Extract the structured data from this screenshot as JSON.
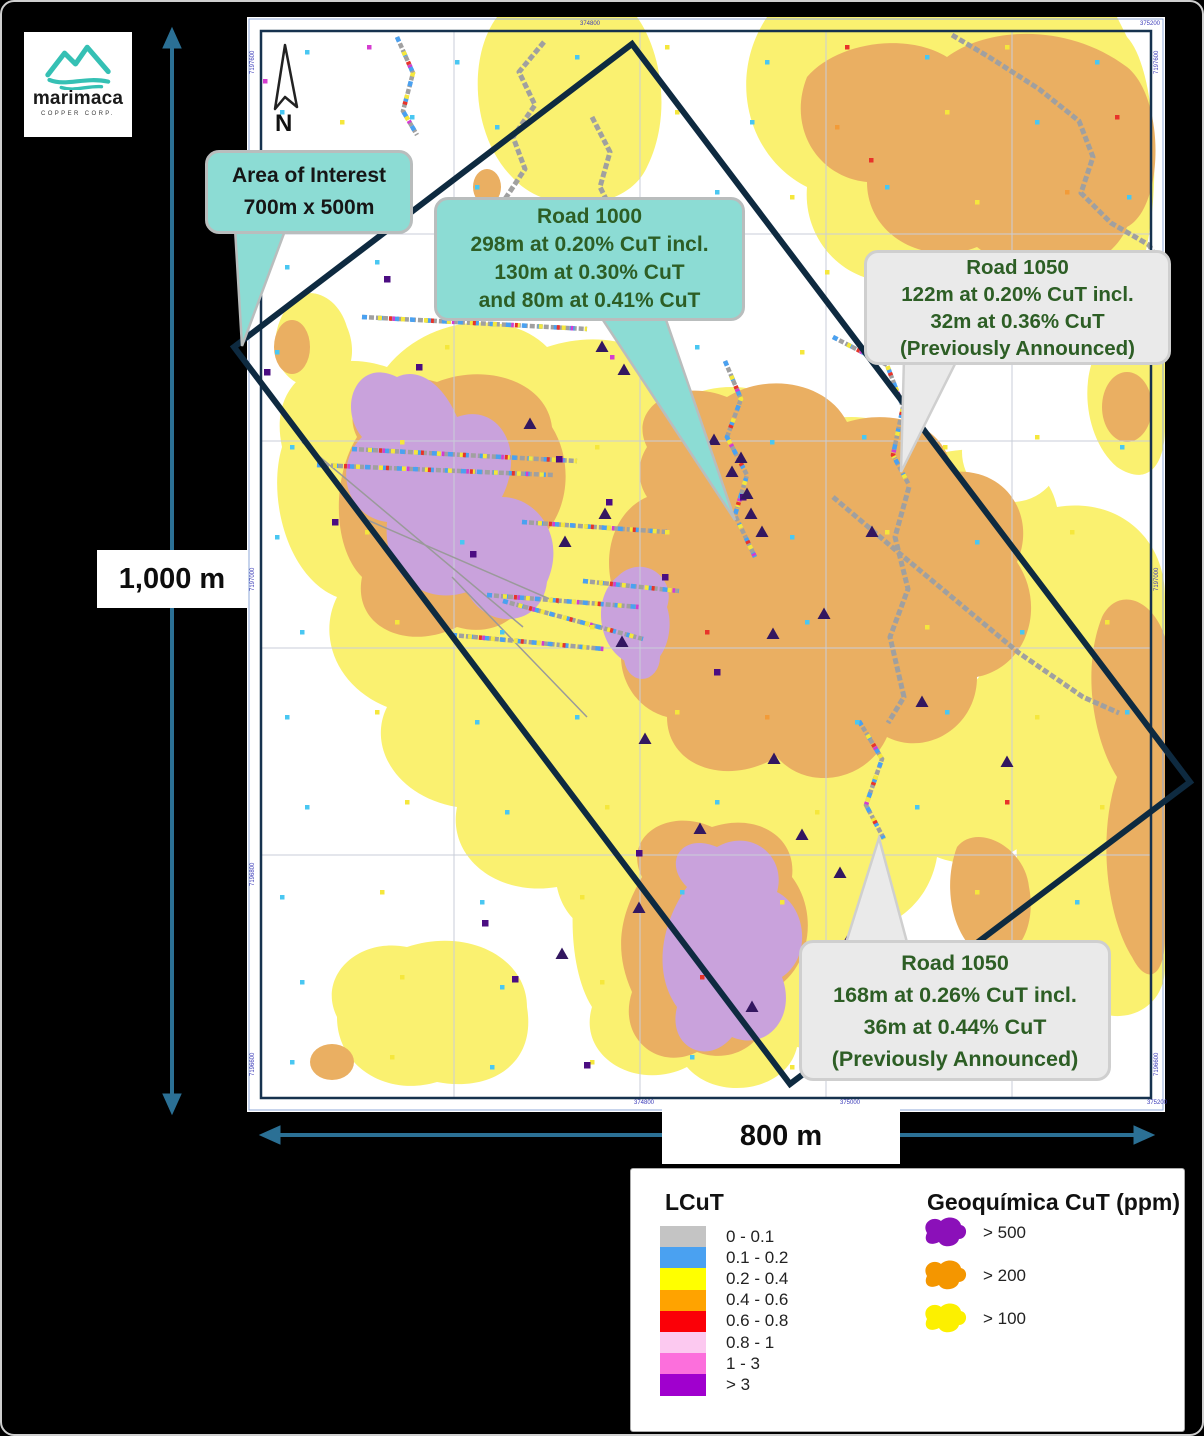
{
  "logo": {
    "wordmark": "marimaca",
    "subtitle": "COPPER CORP.",
    "accent": "#35c0b4"
  },
  "north_arrow_label": "N",
  "scale": {
    "vertical_label": "1,000 m",
    "horizontal_label": "800 m",
    "arrow_color": "#2b7095"
  },
  "callouts": {
    "area_of_interest": {
      "lines": [
        "Area of Interest",
        "700m x 500m"
      ],
      "fill": "#8cdcd4"
    },
    "road1000": {
      "lines": [
        "Road 1000",
        "298m at 0.20% CuT incl.",
        "130m at 0.30% CuT",
        "and 80m at 0.41% CuT"
      ],
      "fill": "#8cdcd4"
    },
    "road1050_top": {
      "lines": [
        "Road 1050",
        "122m at 0.20% CuT incl.",
        "32m at 0.36% CuT",
        "(Previously Announced)"
      ],
      "fill": "#eaeaea"
    },
    "road1050_bottom": {
      "lines": [
        "Road 1050",
        "168m at 0.26% CuT incl.",
        "36m at 0.44% CuT",
        "(Previously Announced)"
      ],
      "fill": "#eaeaea"
    }
  },
  "legend": {
    "lcut": {
      "title": "LCuT",
      "items": [
        {
          "label": "0 - 0.1",
          "color": "#c4c4c4"
        },
        {
          "label": "0.1 - 0.2",
          "color": "#4aa1f1"
        },
        {
          "label": "0.2 - 0.4",
          "color": "#ffff00"
        },
        {
          "label": "0.4 - 0.6",
          "color": "#ffa300"
        },
        {
          "label": "0.6 - 0.8",
          "color": "#fb0007"
        },
        {
          "label": "0.8 - 1",
          "color": "#fcc9f0"
        },
        {
          "label": "1 - 3",
          "color": "#fc6fdc"
        },
        {
          "label": "> 3",
          "color": "#a000ce"
        }
      ]
    },
    "geoquimica": {
      "title": "Geoquímica CuT (ppm)",
      "items": [
        {
          "label": "> 500",
          "color": "#8b10b9"
        },
        {
          "label": "> 200",
          "color": "#f49600"
        },
        {
          "label": "> 100",
          "color": "#fcf000"
        }
      ]
    }
  },
  "map": {
    "colors": {
      "anomaly_yellow": "#faf170",
      "anomaly_orange": "#eaaf62",
      "anomaly_purple": "#c9a2dc",
      "road": "#a0a0a0",
      "triangle": "#331760",
      "square": "#4b0d82",
      "aoi_rectangle": "#0e2a40",
      "frame": "#16324e",
      "grid": "#c9cdd9"
    },
    "palette": [
      "#49c7f2",
      "#f5e73c",
      "#e8332a",
      "#f29b38",
      "#d53cd0",
      "#4aa1f1"
    ],
    "coord_labels": {
      "top": [
        {
          "x": 333,
          "t": "374800"
        },
        {
          "x": 893,
          "t": "375200"
        }
      ],
      "bottom": [
        {
          "x": 387,
          "t": "374800"
        },
        {
          "x": 593,
          "t": "375000"
        },
        {
          "x": 900,
          "t": "375200"
        }
      ],
      "left": [
        {
          "y": 33,
          "t": "7197600"
        },
        {
          "y": 550,
          "t": "7197000"
        },
        {
          "y": 845,
          "t": "7196800"
        },
        {
          "y": 1035,
          "t": "7196600"
        }
      ],
      "right": [
        {
          "y": 33,
          "t": "7197600"
        },
        {
          "y": 550,
          "t": "7197000"
        },
        {
          "y": 1035,
          "t": "7196600"
        }
      ]
    },
    "trenches": {
      "roads": [
        "705,18 742,40 792,72 832,104 846,140 834,176 864,206 902,228 916,252",
        "806,252 852,286 896,312 916,332",
        "586,480 652,536 712,586 772,636 836,680 872,696",
        "345,100 363,135 353,170 368,200",
        "297,25 272,55 288,88 266,120 278,152 258,182",
        "662,470 648,520 661,572 643,620 657,680 641,706"
      ],
      "assay": [
        "150,20 166,56 156,94 170,118",
        "105,432 330,444",
        "70,448 306,458",
        "115,300 340,312",
        "478,344 494,382 480,420 500,458 488,498 508,540",
        "586,320 640,348 656,390 646,438 662,468",
        "612,704 635,742 619,788 637,822",
        "240,578 392,590",
        "205,618 357,632",
        "256,584 396,622",
        "336,564 432,574",
        "275,505 420,515"
      ]
    },
    "triangles": [
      [
        355,
        330
      ],
      [
        377,
        353
      ],
      [
        283,
        407
      ],
      [
        467,
        423
      ],
      [
        494,
        441
      ],
      [
        504,
        497
      ],
      [
        358,
        497
      ],
      [
        577,
        597
      ],
      [
        526,
        617
      ],
      [
        398,
        722
      ],
      [
        527,
        742
      ],
      [
        555,
        818
      ],
      [
        453,
        812
      ],
      [
        392,
        891
      ],
      [
        315,
        937
      ],
      [
        593,
        856
      ],
      [
        505,
        990
      ],
      [
        600,
        925
      ],
      [
        675,
        685
      ],
      [
        760,
        745
      ],
      [
        625,
        515
      ],
      [
        515,
        515
      ],
      [
        485,
        455
      ],
      [
        500,
        477
      ],
      [
        375,
        625
      ],
      [
        415,
        360
      ],
      [
        367,
        285
      ],
      [
        318,
        525
      ]
    ],
    "squares": [
      [
        20,
        355
      ],
      [
        172,
        350
      ],
      [
        88,
        505
      ],
      [
        140,
        262
      ],
      [
        226,
        537
      ],
      [
        312,
        442
      ],
      [
        392,
        250
      ],
      [
        362,
        485
      ],
      [
        496,
        480
      ],
      [
        418,
        560
      ],
      [
        470,
        655
      ],
      [
        392,
        836
      ],
      [
        340,
        1048
      ],
      [
        238,
        906
      ],
      [
        268,
        962
      ]
    ],
    "dots": [
      [
        60,
        35,
        0
      ],
      [
        122,
        30,
        4
      ],
      [
        210,
        45,
        0
      ],
      [
        330,
        40,
        0
      ],
      [
        420,
        30,
        1
      ],
      [
        520,
        45,
        0
      ],
      [
        600,
        30,
        2
      ],
      [
        680,
        40,
        0
      ],
      [
        760,
        30,
        1
      ],
      [
        850,
        45,
        0
      ],
      [
        35,
        95,
        0
      ],
      [
        95,
        105,
        1
      ],
      [
        165,
        100,
        0
      ],
      [
        250,
        110,
        0
      ],
      [
        430,
        95,
        1
      ],
      [
        505,
        105,
        0
      ],
      [
        590,
        110,
        3
      ],
      [
        700,
        95,
        1
      ],
      [
        790,
        105,
        0
      ],
      [
        870,
        100,
        2
      ],
      [
        55,
        170,
        1
      ],
      [
        140,
        180,
        0
      ],
      [
        230,
        170,
        0
      ],
      [
        320,
        185,
        1
      ],
      [
        470,
        175,
        0
      ],
      [
        545,
        180,
        1
      ],
      [
        640,
        170,
        0
      ],
      [
        730,
        185,
        1
      ],
      [
        820,
        175,
        3
      ],
      [
        882,
        180,
        0
      ],
      [
        40,
        250,
        0
      ],
      [
        130,
        245,
        0
      ],
      [
        300,
        255,
        0
      ],
      [
        420,
        250,
        2
      ],
      [
        495,
        245,
        0
      ],
      [
        580,
        255,
        1
      ],
      [
        668,
        248,
        1
      ],
      [
        755,
        250,
        0
      ],
      [
        855,
        255,
        1
      ],
      [
        30,
        335,
        0
      ],
      [
        200,
        330,
        1
      ],
      [
        365,
        340,
        4
      ],
      [
        450,
        330,
        0
      ],
      [
        555,
        335,
        1
      ],
      [
        720,
        330,
        0
      ],
      [
        800,
        340,
        1
      ],
      [
        890,
        330,
        1
      ],
      [
        45,
        430,
        0
      ],
      [
        155,
        425,
        1
      ],
      [
        350,
        430,
        1
      ],
      [
        525,
        425,
        0
      ],
      [
        617,
        420,
        0
      ],
      [
        698,
        430,
        1
      ],
      [
        790,
        420,
        1
      ],
      [
        875,
        430,
        0
      ],
      [
        30,
        520,
        0
      ],
      [
        120,
        515,
        1
      ],
      [
        215,
        525,
        0
      ],
      [
        420,
        515,
        1
      ],
      [
        545,
        520,
        0
      ],
      [
        640,
        515,
        1
      ],
      [
        730,
        525,
        0
      ],
      [
        825,
        515,
        1
      ],
      [
        55,
        615,
        0
      ],
      [
        150,
        605,
        1
      ],
      [
        255,
        615,
        0
      ],
      [
        345,
        610,
        1
      ],
      [
        460,
        615,
        2
      ],
      [
        560,
        605,
        0
      ],
      [
        680,
        610,
        1
      ],
      [
        775,
        615,
        0
      ],
      [
        860,
        605,
        1
      ],
      [
        40,
        700,
        0
      ],
      [
        130,
        695,
        1
      ],
      [
        230,
        705,
        0
      ],
      [
        330,
        700,
        0
      ],
      [
        430,
        695,
        1
      ],
      [
        520,
        700,
        3
      ],
      [
        610,
        705,
        0
      ],
      [
        700,
        695,
        0
      ],
      [
        790,
        700,
        1
      ],
      [
        880,
        695,
        0
      ],
      [
        60,
        790,
        0
      ],
      [
        160,
        785,
        1
      ],
      [
        260,
        795,
        0
      ],
      [
        360,
        790,
        1
      ],
      [
        470,
        785,
        0
      ],
      [
        570,
        795,
        1
      ],
      [
        670,
        790,
        0
      ],
      [
        760,
        785,
        2
      ],
      [
        855,
        790,
        1
      ],
      [
        35,
        880,
        0
      ],
      [
        135,
        875,
        1
      ],
      [
        235,
        885,
        0
      ],
      [
        335,
        880,
        1
      ],
      [
        435,
        875,
        0
      ],
      [
        535,
        885,
        1
      ],
      [
        635,
        880,
        0
      ],
      [
        730,
        875,
        1
      ],
      [
        830,
        885,
        0
      ],
      [
        55,
        965,
        0
      ],
      [
        155,
        960,
        1
      ],
      [
        255,
        970,
        0
      ],
      [
        355,
        965,
        1
      ],
      [
        455,
        960,
        2
      ],
      [
        555,
        970,
        0
      ],
      [
        655,
        965,
        1
      ],
      [
        755,
        960,
        0
      ],
      [
        850,
        970,
        1
      ],
      [
        45,
        1045,
        0
      ],
      [
        145,
        1040,
        1
      ],
      [
        245,
        1050,
        0
      ],
      [
        345,
        1045,
        1
      ],
      [
        445,
        1040,
        0
      ],
      [
        545,
        1050,
        1
      ],
      [
        645,
        1045,
        0
      ],
      [
        745,
        1040,
        1
      ],
      [
        845,
        1050,
        0
      ],
      [
        18,
        64,
        4
      ],
      [
        624,
        143,
        2
      ]
    ]
  }
}
